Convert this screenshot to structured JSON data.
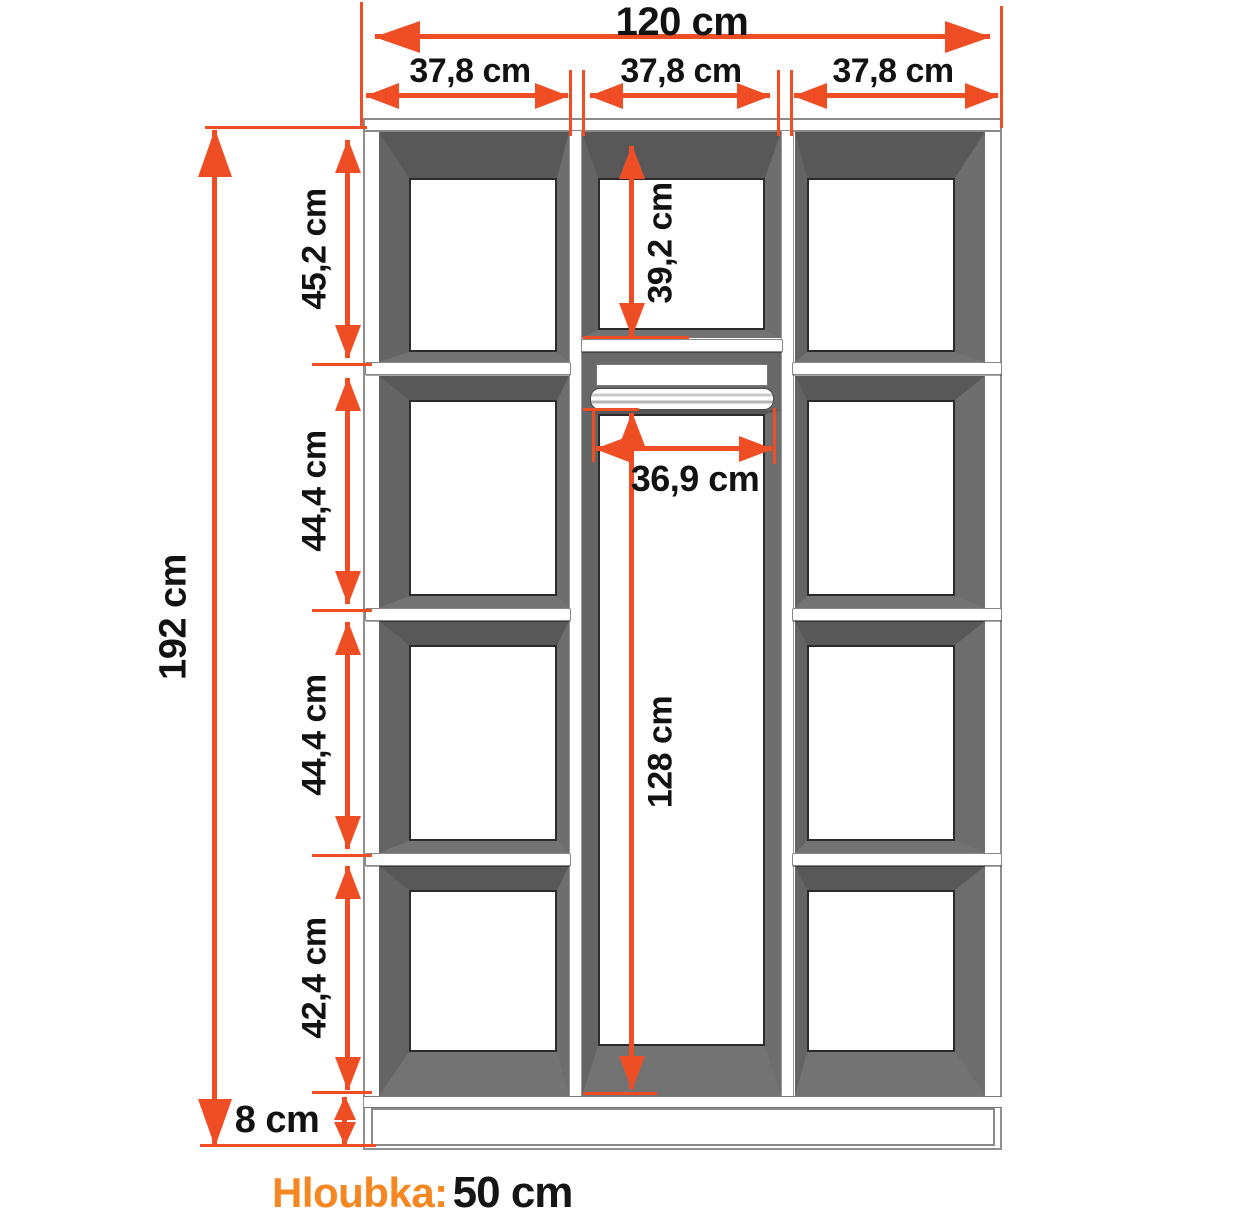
{
  "diagram": {
    "total_width_label": "120 cm",
    "column_width_labels": [
      "37,8 cm",
      "37,8 cm",
      "37,8 cm"
    ],
    "total_height_label": "192 cm",
    "left_section_labels": [
      "45,2 cm",
      "44,4 cm",
      "44,4 cm",
      "42,4 cm"
    ],
    "plinth_height_label": "8 cm",
    "middle_top_section_label": "39,2 cm",
    "rod_width_label": "36,9 cm",
    "hanging_space_label": "128 cm",
    "depth": {
      "label": "Hloubka:",
      "value": "50 cm"
    },
    "colors": {
      "dimension_accent": "#ef4e25",
      "depth_accent": "#f6861f",
      "panel_shade": "#686868"
    }
  }
}
